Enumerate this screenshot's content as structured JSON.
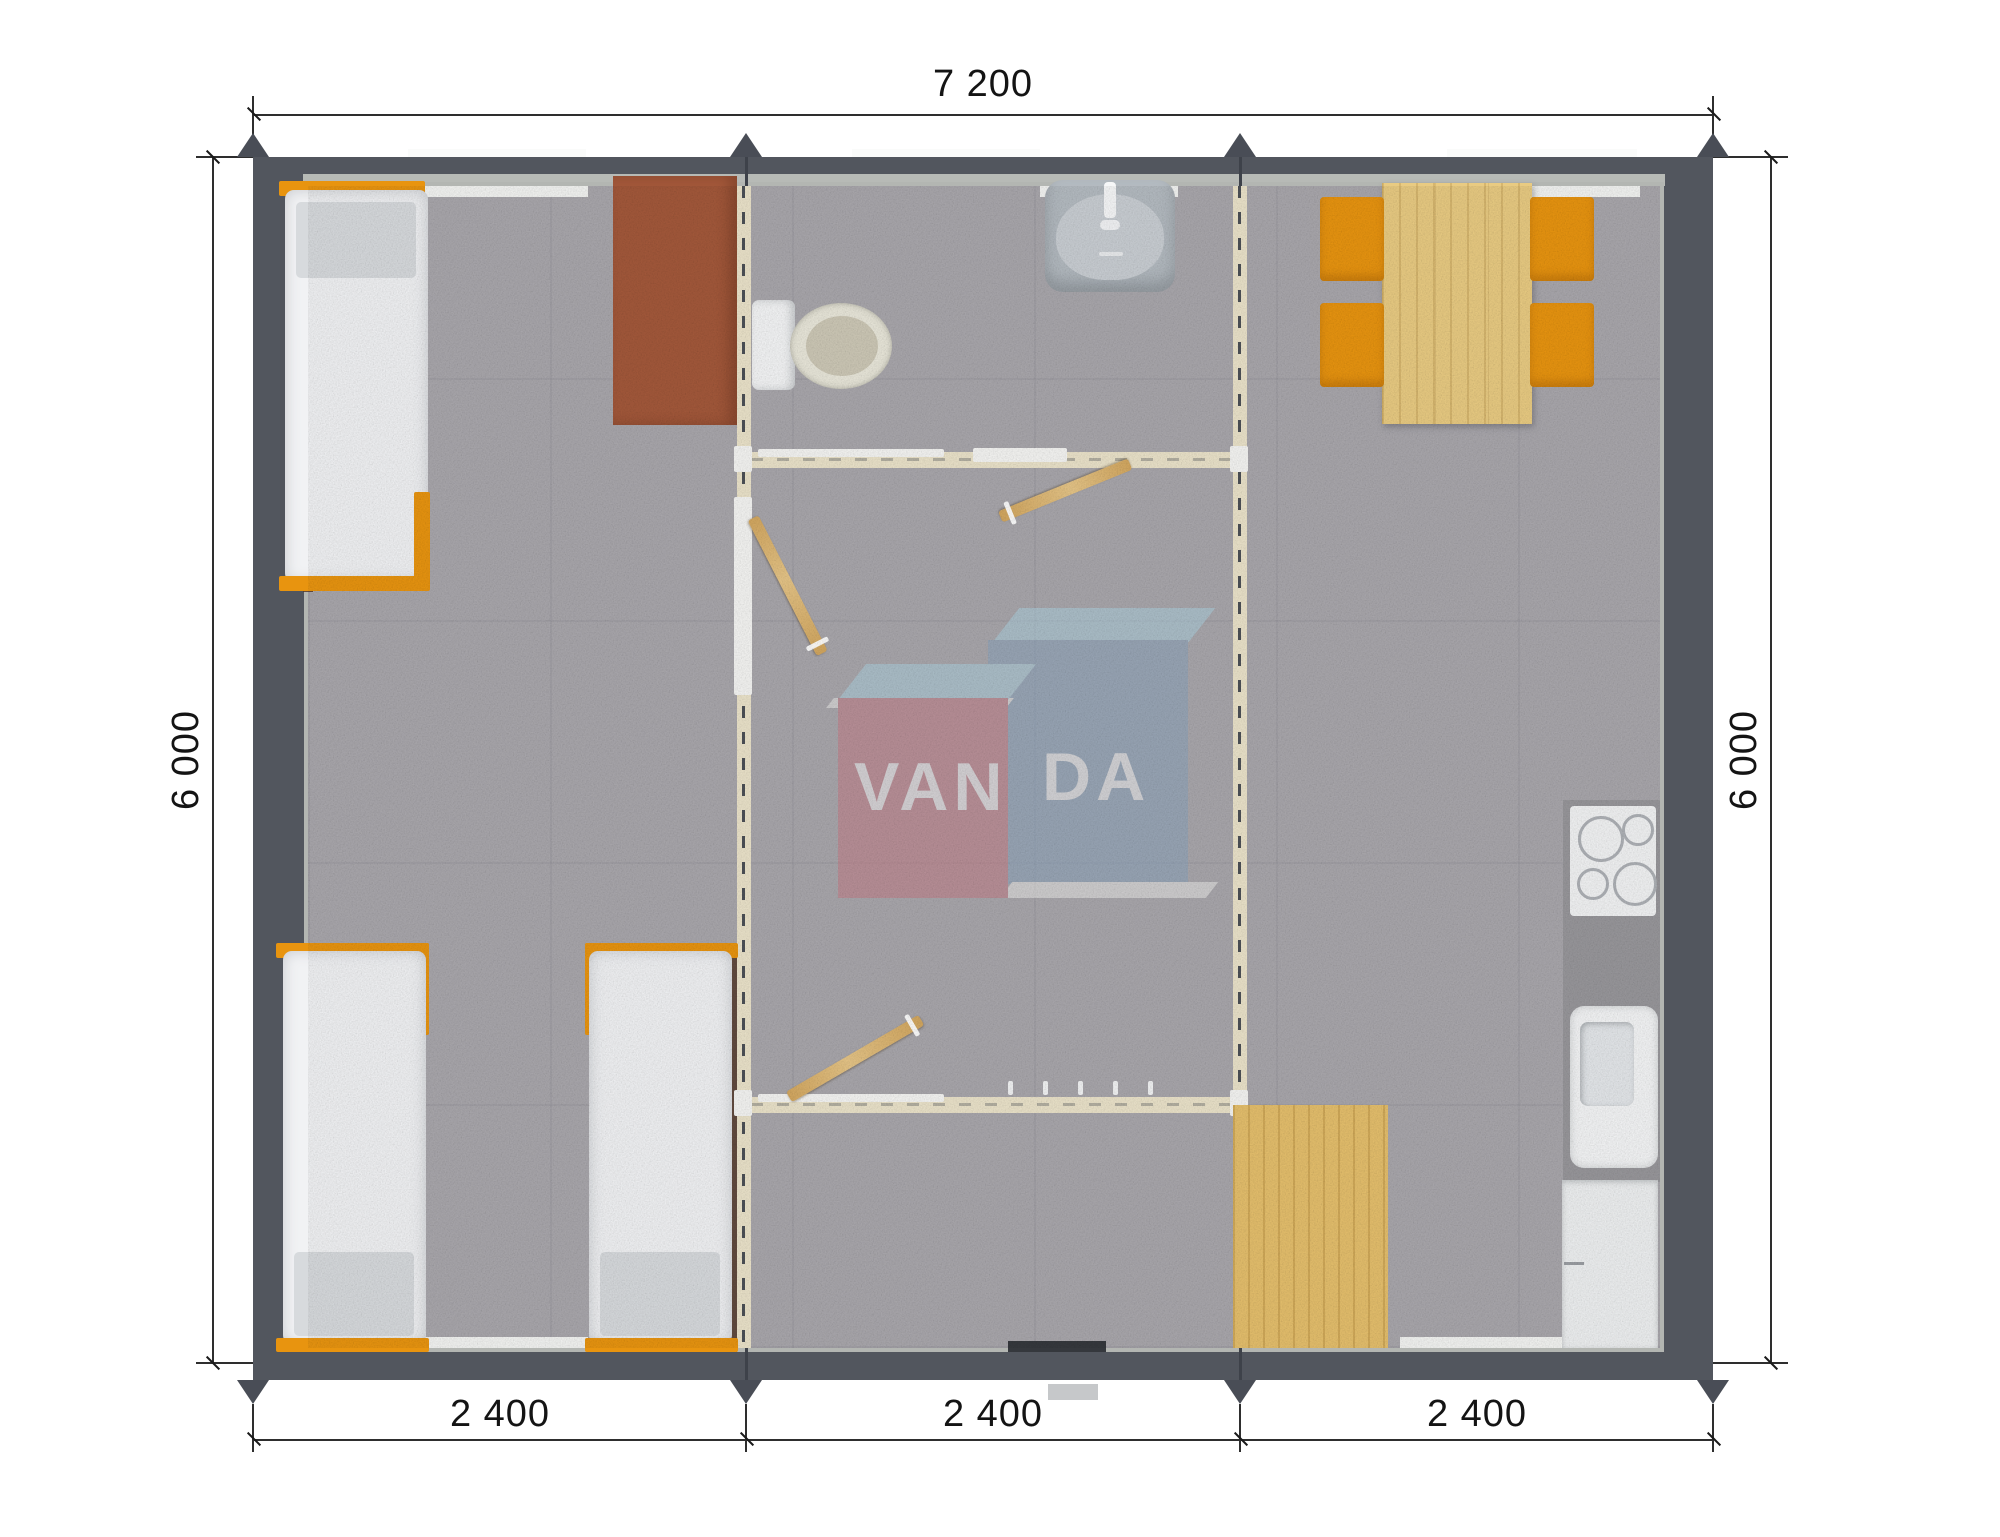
{
  "plan": {
    "watermark": {
      "text_left": "VAN",
      "text_right": "DA"
    },
    "dimensions": {
      "top_width": "7 200",
      "left_height": "6 000",
      "right_height": "6 000",
      "bottom_segments": [
        "2 400",
        "2 400",
        "2 400"
      ]
    },
    "colors": {
      "wall": "#52565e",
      "partition": "#ebe3ca",
      "floor_carpet": "#a9a7ac",
      "furniture_orange": "#e8940f",
      "wood": "#e9cb82",
      "desk_brown": "#a3583a",
      "watermark_red": "#c77a85",
      "watermark_blue": "#8aa5bf",
      "watermark_light_blue": "#aed3e2"
    },
    "furniture_icons": [
      "bed-icon",
      "desk-icon",
      "toilet-icon",
      "wash-basin-icon",
      "door-icon",
      "coat-hooks-icon",
      "dining-table-icon",
      "chair-icon",
      "cooktop-icon",
      "kitchen-sink-icon",
      "cabinet-icon",
      "floor-mat-icon"
    ]
  }
}
